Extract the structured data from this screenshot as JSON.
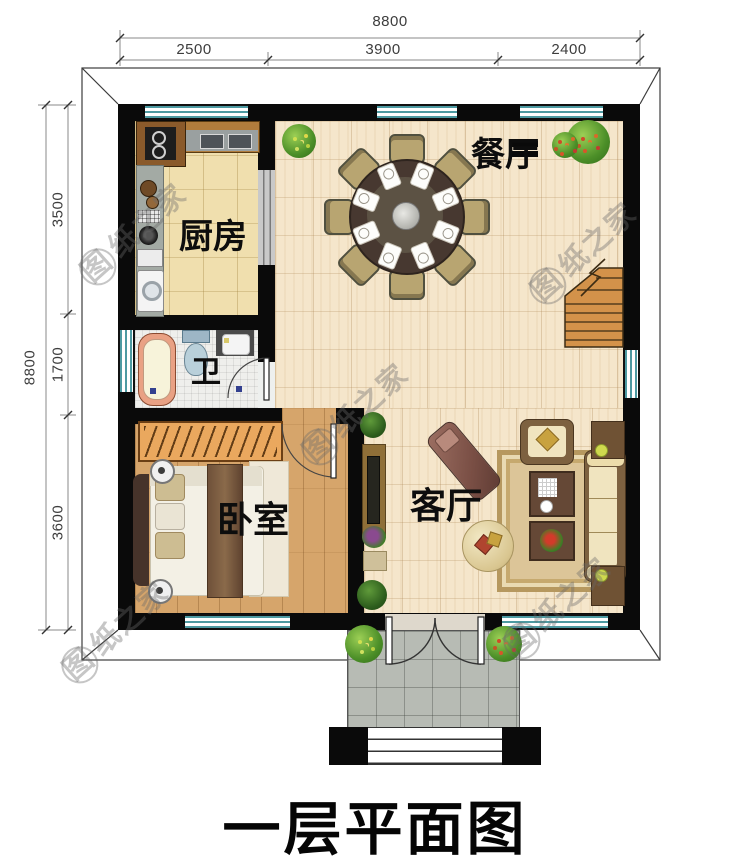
{
  "title": "一层平面图",
  "watermark": {
    "text": "图纸之家",
    "first": "图",
    "rest": "纸之家"
  },
  "rooms": {
    "dining": {
      "label": "餐厅"
    },
    "kitchen": {
      "label": "厨房"
    },
    "bathroom": {
      "label": "卫"
    },
    "bedroom": {
      "label": "卧室"
    },
    "living": {
      "label": "客厅"
    }
  },
  "dimensions": {
    "top": {
      "total": "8800",
      "segments": [
        "2500",
        "3900",
        "2400"
      ]
    },
    "left": {
      "total": "8800",
      "segments": [
        "3500",
        "1700",
        "3600"
      ]
    }
  },
  "colors": {
    "wall": "#0a0a0a",
    "window_stripe": "#4d9aa2",
    "open_floor": "#f5e6cb",
    "kitchen_floor": "#f0dfae",
    "bedroom_floor": "#d6a56b",
    "stair_wood": "#d3924a",
    "label_text": "#0d0d0d"
  }
}
